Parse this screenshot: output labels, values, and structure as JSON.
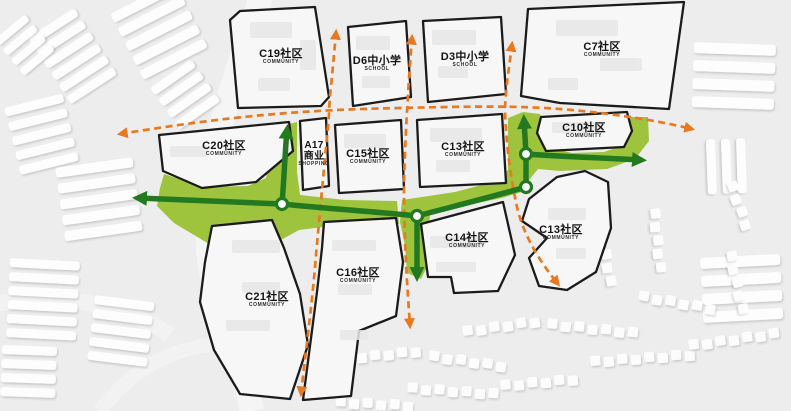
{
  "map": {
    "title": "urban greenway plan",
    "blocks": [
      {
        "id": "C19",
        "label": "C19社区",
        "sublabel": "COMMUNITY"
      },
      {
        "id": "D6",
        "label": "D6中小学",
        "sublabel": "SCHOOL"
      },
      {
        "id": "D3",
        "label": "D3中小学",
        "sublabel": "SCHOOL"
      },
      {
        "id": "C7",
        "label": "C7社区",
        "sublabel": "COMMUNITY"
      },
      {
        "id": "C20",
        "label": "C20社区",
        "sublabel": "COMMUNITY"
      },
      {
        "id": "A17",
        "label": "A17",
        "label2": "商业",
        "sublabel": "SHOPPING"
      },
      {
        "id": "C15",
        "label": "C15社区",
        "sublabel": "COMMUNITY"
      },
      {
        "id": "C13N",
        "label": "C13社区",
        "sublabel": "COMMUNITY"
      },
      {
        "id": "C10",
        "label": "C10社区",
        "sublabel": "COMMUNITY"
      },
      {
        "id": "C14",
        "label": "C14社区",
        "sublabel": "COMMUNITY"
      },
      {
        "id": "C13S",
        "label": "C13社区",
        "sublabel": "COMMUNITY"
      },
      {
        "id": "C16",
        "label": "C16社区",
        "sublabel": "COMMUNITY"
      },
      {
        "id": "C21",
        "label": "C21社区",
        "sublabel": "COMMUNITY"
      }
    ],
    "colors": {
      "background": "#ededed",
      "greenway_area": "#9ec33c",
      "greenway_line": "#23791f",
      "road_arrow": "#e8791f",
      "block_outline": "#1b1b1b",
      "block_fill": "#f7f7f7"
    }
  }
}
